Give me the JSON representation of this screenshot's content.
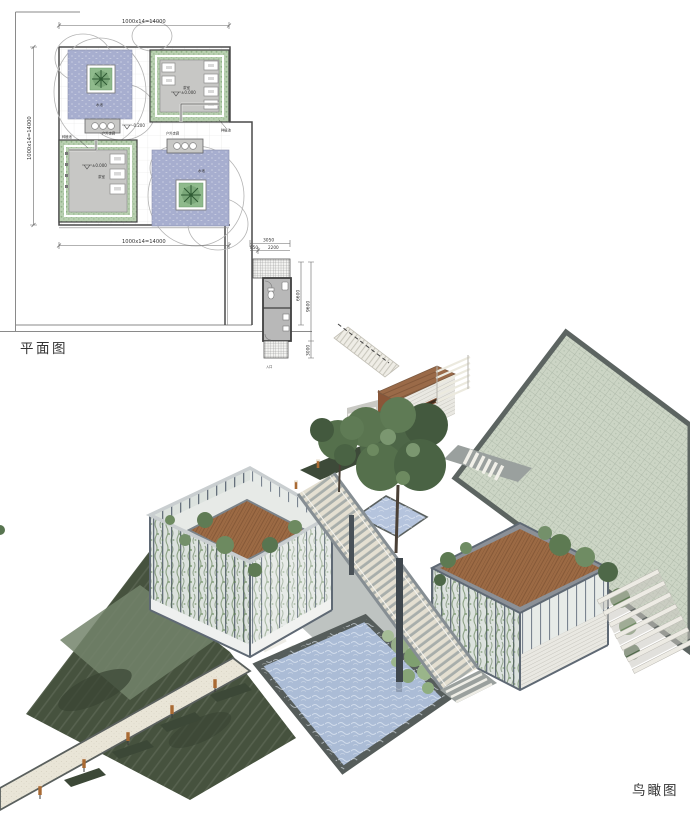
{
  "sheet": {
    "plan_title": "平面图",
    "render_title": "鸟瞰图"
  },
  "plan": {
    "dimensions": {
      "top": "1000x14=14000",
      "left": "1000x14=14000",
      "bottom": "1000x14=14000",
      "annex_total": "3050",
      "annex_seg_a": "850",
      "annex_seg_b": "2200",
      "annex_right_inner": "6600",
      "annex_right_outer": "9600",
      "annex_right_lower": "3000"
    },
    "levels": {
      "zero": "±0.000",
      "minus": "-0.200"
    },
    "labels": {
      "corridor_left": "户外走廊",
      "corridor_right": "户外走廊",
      "pool_tl": "水池",
      "pool_br": "水池",
      "room_tr": "茶室",
      "room_bl": "茶室",
      "planting_tr": "种植池",
      "planting_bl": "种植池",
      "entry": "入口"
    }
  },
  "colors": {
    "roof_brown": "#9c6a44",
    "plaza_paving": "#ccd5c5",
    "render_water": "#abbcd6",
    "lawn_dark": "#46523e",
    "plan_water": "#a7aecf",
    "plan_planting": "#b9d0b1",
    "path_beige": "#e9e5d7",
    "structure_gray": "#7d858b",
    "lamp_orange": "#a96a33"
  }
}
